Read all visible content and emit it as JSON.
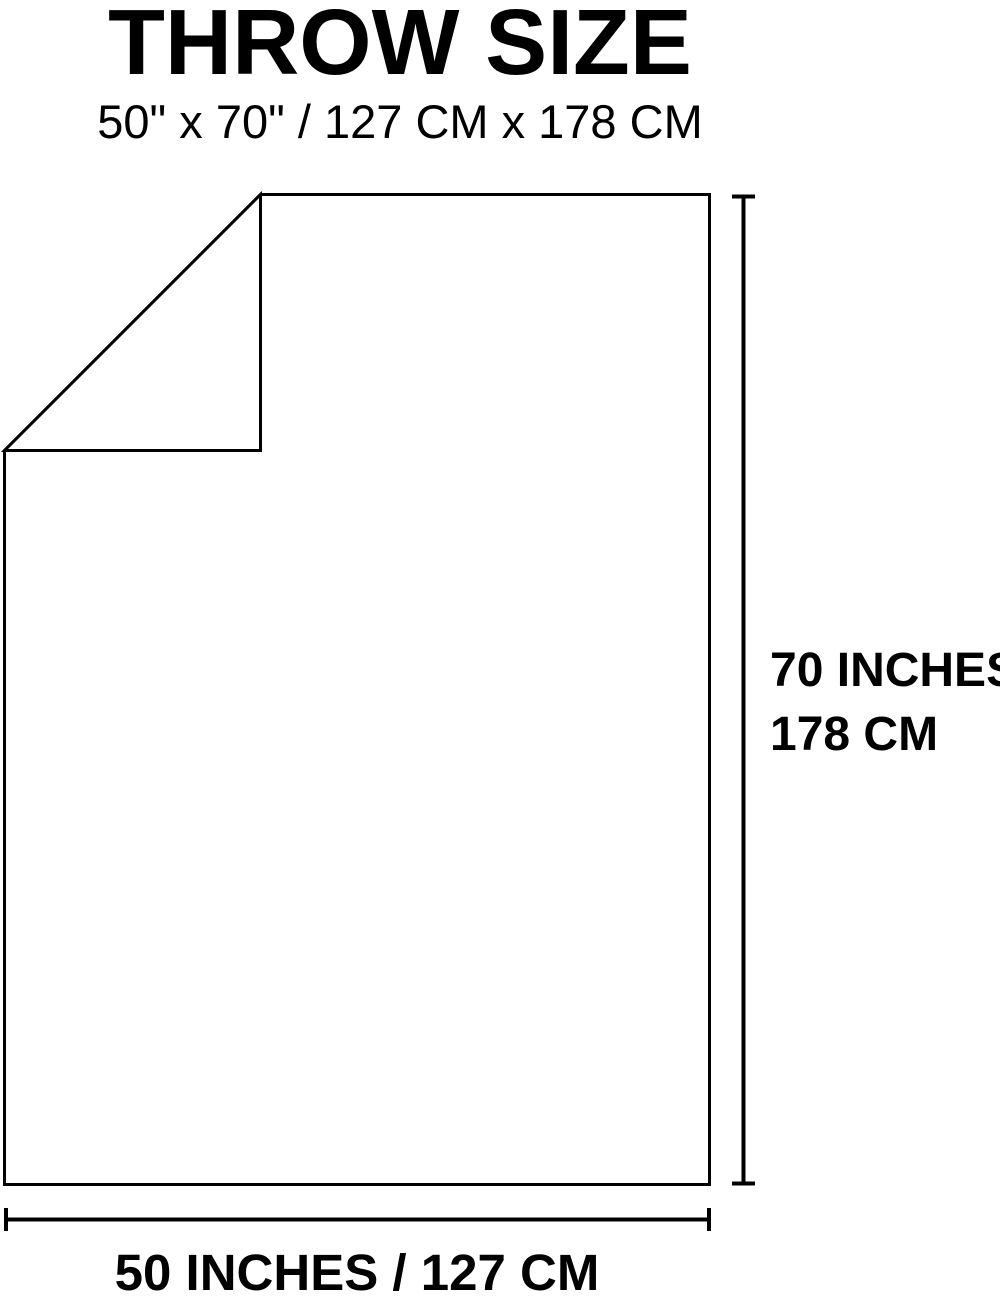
{
  "page": {
    "background_color": "#ffffff",
    "line_color": "#000000",
    "text_color": "#000000"
  },
  "header": {
    "title": "THROW SIZE",
    "subtitle": "50\" x 70\" / 127 CM x 178 CM"
  },
  "diagram": {
    "height_label": {
      "line1": "70 INCHES",
      "line2": "178 CM"
    },
    "width_label": "50 INCHES / 127 CM",
    "dimensions": {
      "width_inches": 50,
      "height_inches": 70,
      "width_cm": 127,
      "height_cm": 178
    }
  }
}
